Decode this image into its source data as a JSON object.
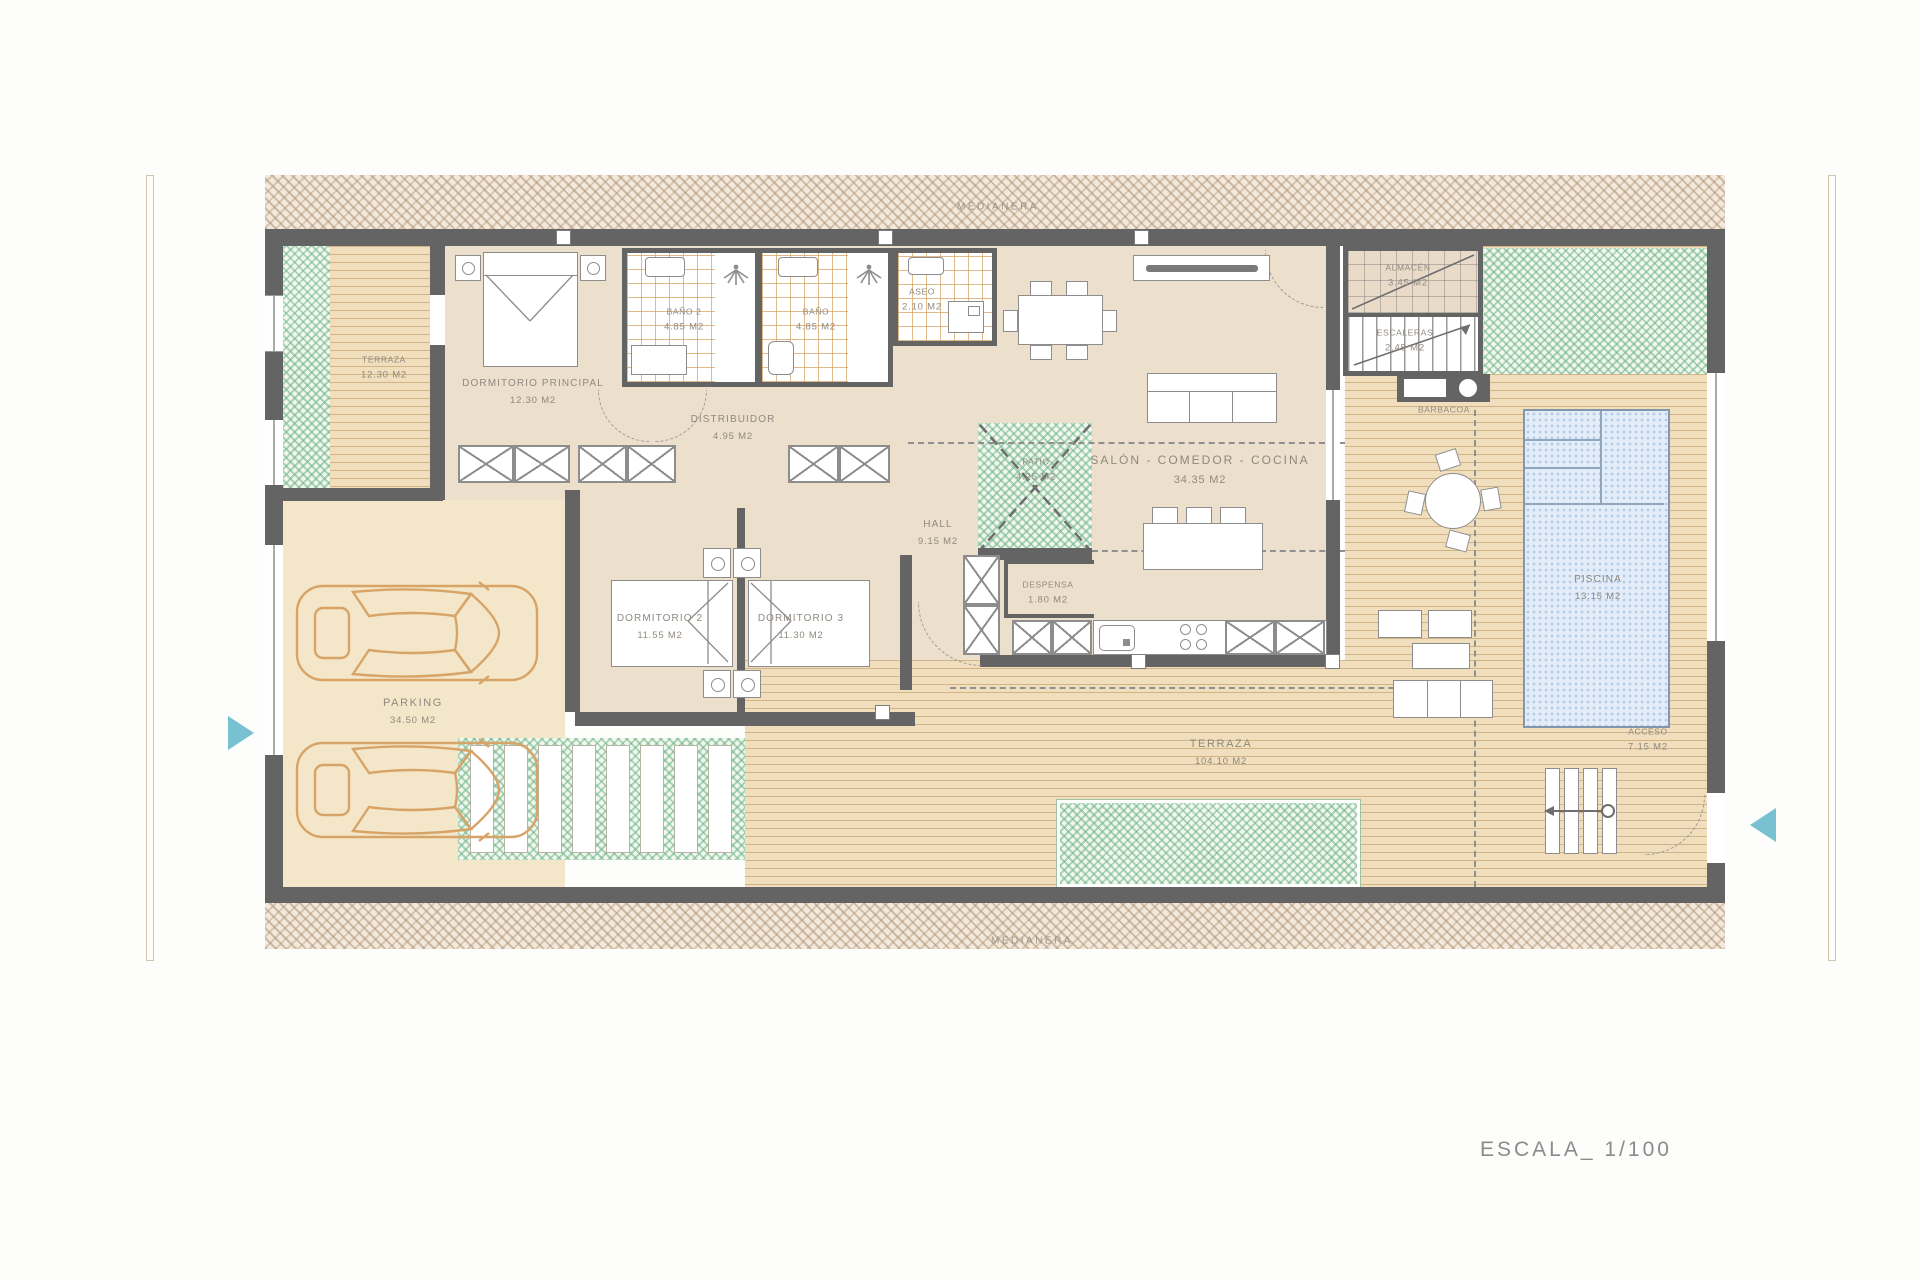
{
  "page": {
    "scale_label": "ESCALA_ 1/100"
  },
  "boundaries": {
    "top_label": "MEDIANERA",
    "bottom_label": "MEDIANERA"
  },
  "colors": {
    "wall": "#646464",
    "accent_teal": "#5fb6c9",
    "green_hatch": "#7fbf8f",
    "pool_blue": "#dbe9f8",
    "car_outline": "#d7a468",
    "label_gray": "#90897f"
  },
  "icons": {
    "left_access": "access-arrow-icon",
    "right_access": "access-arrow-icon",
    "shower": "shower-icon"
  },
  "rooms": {
    "terraza_left": {
      "name": "TERRAZA",
      "area": "12.30 m2"
    },
    "dormitorio_ppal": {
      "name": "DORMITORIO PRINCIPAL",
      "area": "12.30 m2"
    },
    "bano2": {
      "name": "BAÑO 2",
      "area": "4.85 m2"
    },
    "bano": {
      "name": "BAÑO",
      "area": "4.85 m2"
    },
    "aseo": {
      "name": "ASEO",
      "area": "2.10 m2"
    },
    "distribuidor": {
      "name": "DISTRIBUIDOR",
      "area": "4.95 m2"
    },
    "dormitorio2": {
      "name": "DORMITORIO 2",
      "area": "11.55 m2"
    },
    "dormitorio3": {
      "name": "DORMITORIO 3",
      "area": "11.30 m2"
    },
    "hall": {
      "name": "HALL",
      "area": "9.15 m2"
    },
    "patio": {
      "name": "PATIO",
      "area": "4.25 m2"
    },
    "salon": {
      "name": "SALÓN - COMEDOR - COCINA",
      "area": "34.35 m2"
    },
    "despensa": {
      "name": "DESPENSA",
      "area": "1.80 m2"
    },
    "almacen": {
      "name": "ALMACÉN",
      "area": "3.45 m2"
    },
    "escaleras": {
      "name": "ESCALERAS",
      "area": "2.45 m2"
    },
    "barbacoa": {
      "name": "BARBACOA"
    },
    "parking": {
      "name": "PARKING",
      "area": "34.50 m2"
    },
    "piscina": {
      "name": "PISCINA",
      "area": "13.15 m2"
    },
    "terraza_main": {
      "name": "TERRAZA",
      "area": "104.10 m2"
    },
    "acceso": {
      "name": "ACCESO",
      "area": "7.15 m2"
    }
  }
}
